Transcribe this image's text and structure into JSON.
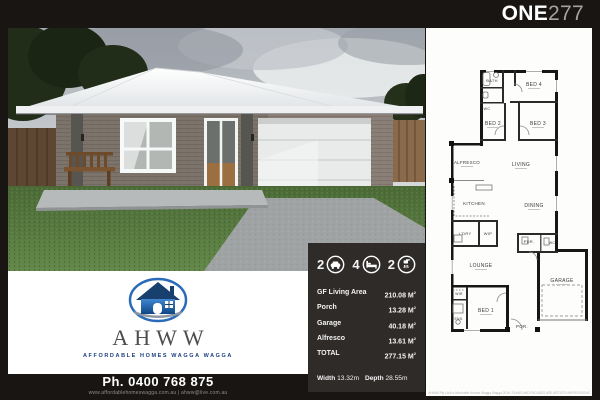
{
  "header": {
    "model_bold": "ONE",
    "model_light": "277"
  },
  "logo": {
    "brand": "AHWW",
    "tagline": "AFFORDABLE HOMES WAGGA WAGGA"
  },
  "contact": {
    "phone": "Ph. 0400 768 875",
    "web": "www.affordablehomeswagga.com.au | ahww@live.com.au"
  },
  "specs": {
    "icons": [
      {
        "name": "garage-car",
        "count": "2"
      },
      {
        "name": "bedrooms",
        "count": "4"
      },
      {
        "name": "bathrooms",
        "count": "2"
      }
    ],
    "rows": [
      {
        "label": "GF Living Area",
        "value": "210.08"
      },
      {
        "label": "Porch",
        "value": "13.28"
      },
      {
        "label": "Garage",
        "value": "40.18"
      },
      {
        "label": "Alfresco",
        "value": "13.61"
      },
      {
        "label": "TOTAL",
        "value": "277.15"
      }
    ],
    "unit": " M",
    "unit_sup": "2",
    "width_label": "Width",
    "width_value": "13.32m",
    "depth_label": "Depth",
    "depth_value": "28.55m"
  },
  "floorplan": {
    "rooms": {
      "bath": "BATH",
      "wc": "WC",
      "bed4": "BED 4",
      "bed2": "BED 2",
      "bed3": "BED 3",
      "alfresco": "ALFRESCO",
      "living": "LIVING",
      "kitchen": "KITCHEN",
      "dining": "DINING",
      "ldry": "L'DRY",
      "wip": "WIP",
      "pdr": "PDR.",
      "wc2": "WC",
      "lounge": "LOUNGE",
      "garage": "GARAGE",
      "wir": "WIR",
      "bed1": "BED 1",
      "ens": "ENS.",
      "por": "POR."
    },
    "disclaimer": "AHWW Pty Ltd t/a Affordable Homes Wagga Wagga 2016. PLANS AND FACADES ARE ARTISTS IMPRESSIONS"
  },
  "colors": {
    "logo_blue": "#2b6cb8",
    "panel_dark": "#2e2b29",
    "frame_black": "#181512"
  }
}
